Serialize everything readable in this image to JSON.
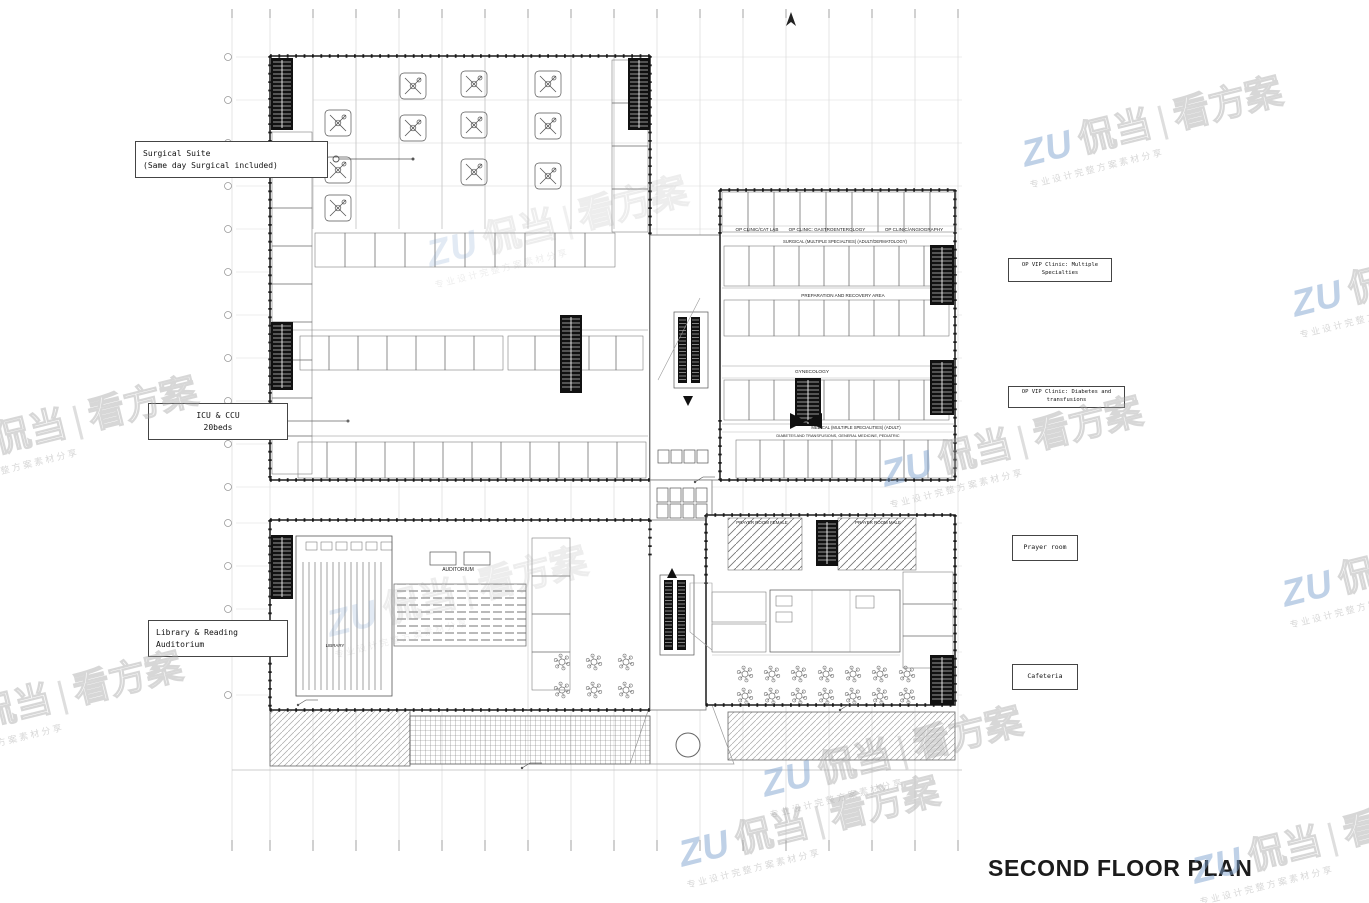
{
  "page": {
    "title": "SECOND FLOOR PLAN"
  },
  "watermark": {
    "brand": "ZU",
    "name": "侃当",
    "divider": "|",
    "suffix": "看方案",
    "subtext": "专业设计完整方案素材分享"
  },
  "callouts": {
    "surgical": {
      "label": "Surgical Suite\n(Same day Surgical  included)"
    },
    "icu": {
      "label": "ICU & CCU\n20beds"
    },
    "library": {
      "label": "Library & Reading\nAuditorium"
    },
    "vip_multiple": {
      "label": "OP VIP Clinic: Multiple Specialties"
    },
    "vip_diabetes": {
      "label": "OP VIP Clinic: Diabetes and transfusions"
    },
    "prayer": {
      "label": "Prayer room"
    },
    "cafeteria": {
      "label": "Cafeteria"
    }
  },
  "plan": {
    "room_labels": {
      "op_clinic_cat_lab": "OP CLINIC/CAT LAB",
      "op_clinic_gastro": "OP CLINIC: GASTROENTEROLOGY",
      "op_clinic_angio": "OP CLINIC/ANGIOGRAPHY",
      "surgical_specialties": "SURGICAL (MULTIPLE SPECIALTIES) (ADULT/DERMATOLOGY)",
      "prep_recovery": "PREPARATION AND RECOVERY AREA",
      "gynecology": "GYNECOLOGY",
      "medical_specialties": "MEDICAL (MULTIPLE SPECIALITIES) (ADULT)",
      "diabetes_row": "DIABETES AND TRANSFUSIONS, GENERAL MEDICINE, PEDIATRIC",
      "prayer_female": "PRAYER ROOM FEMALE",
      "prayer_male": "PRAYER ROOM MALE",
      "auditorium": "AUDITORIUM",
      "library": "LIBRARY"
    },
    "colors": {
      "ink": "#1a1a1a",
      "grid": "#cfcfcf",
      "watermark_blue": "#80a3d0"
    }
  }
}
